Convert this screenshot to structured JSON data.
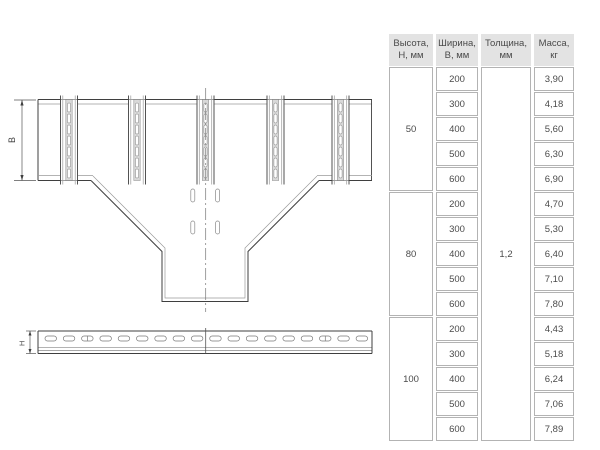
{
  "drawing": {
    "top_view": {
      "width_dim_label": "В"
    },
    "side_view": {
      "height_dim_label": "Н"
    }
  },
  "table": {
    "headers": [
      "Высота, Н, мм",
      "Ширина, В, мм",
      "Толщина, мм",
      "Масса, кг"
    ],
    "thickness": "1,2",
    "groups": [
      {
        "height": "50",
        "rows": [
          {
            "width": "200",
            "mass": "3,90"
          },
          {
            "width": "300",
            "mass": "4,18"
          },
          {
            "width": "400",
            "mass": "5,60"
          },
          {
            "width": "500",
            "mass": "6,30"
          },
          {
            "width": "600",
            "mass": "6,90"
          }
        ]
      },
      {
        "height": "80",
        "rows": [
          {
            "width": "200",
            "mass": "4,70"
          },
          {
            "width": "300",
            "mass": "5,30"
          },
          {
            "width": "400",
            "mass": "6,40"
          },
          {
            "width": "500",
            "mass": "7,10"
          },
          {
            "width": "600",
            "mass": "7,80"
          }
        ]
      },
      {
        "height": "100",
        "rows": [
          {
            "width": "200",
            "mass": "4,43"
          },
          {
            "width": "300",
            "mass": "5,18"
          },
          {
            "width": "400",
            "mass": "6,24"
          },
          {
            "width": "500",
            "mass": "7,06"
          },
          {
            "width": "600",
            "mass": "7,89"
          }
        ]
      }
    ]
  }
}
